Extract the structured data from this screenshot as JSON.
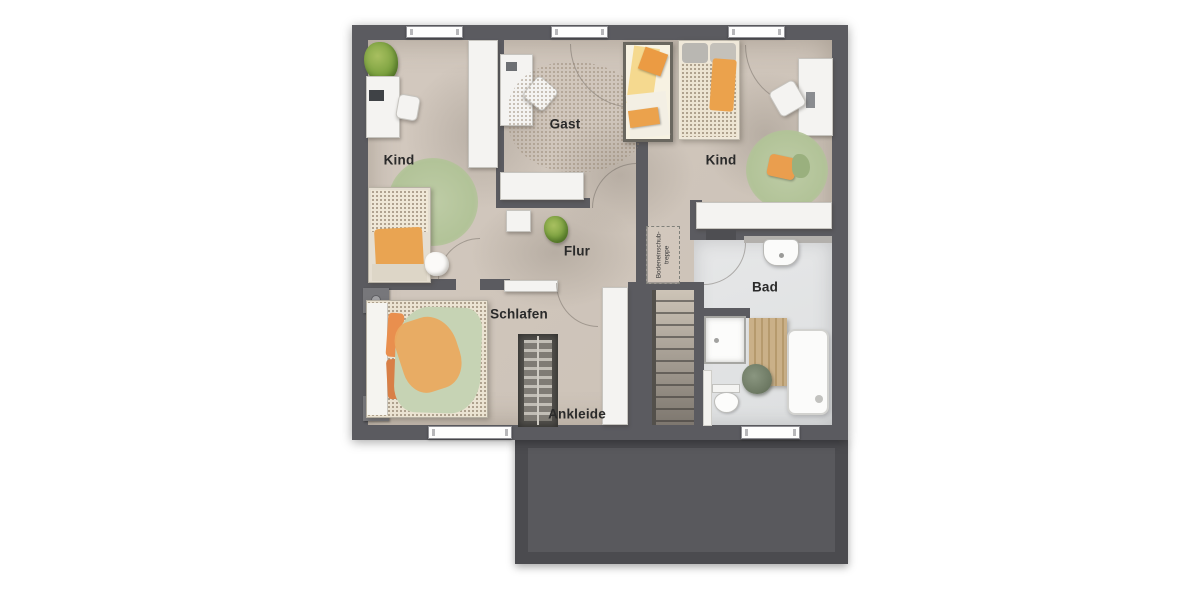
{
  "title": "Obergeschoss Grundriss (upper-floor plan)",
  "labels": {
    "kind_left": "Kind",
    "gast": "Gast",
    "kind_right": "Kind",
    "flur": "Flur",
    "schlafen": "Schlafen",
    "ankleide": "Ankleide",
    "bad": "Bad",
    "attic_hatch_line1": "Bodeneinschub-",
    "attic_hatch_line2": "treppe"
  },
  "colors": {
    "wall": "#5b5b60",
    "floor": "#cfc5bb",
    "bath_floor": "#e3e4e5",
    "roof_slab": "#4b4b4f",
    "roof_slab_inner": "#59595d",
    "rug_green": "#b5c69d",
    "accent_orange": "#e9a452",
    "duvet_green": "#c6d3b4",
    "furniture_white": "#f4f3f1",
    "label_text": "#2a2a2a"
  },
  "counts": {
    "windows_top": 3,
    "windows_bottom": 2
  }
}
